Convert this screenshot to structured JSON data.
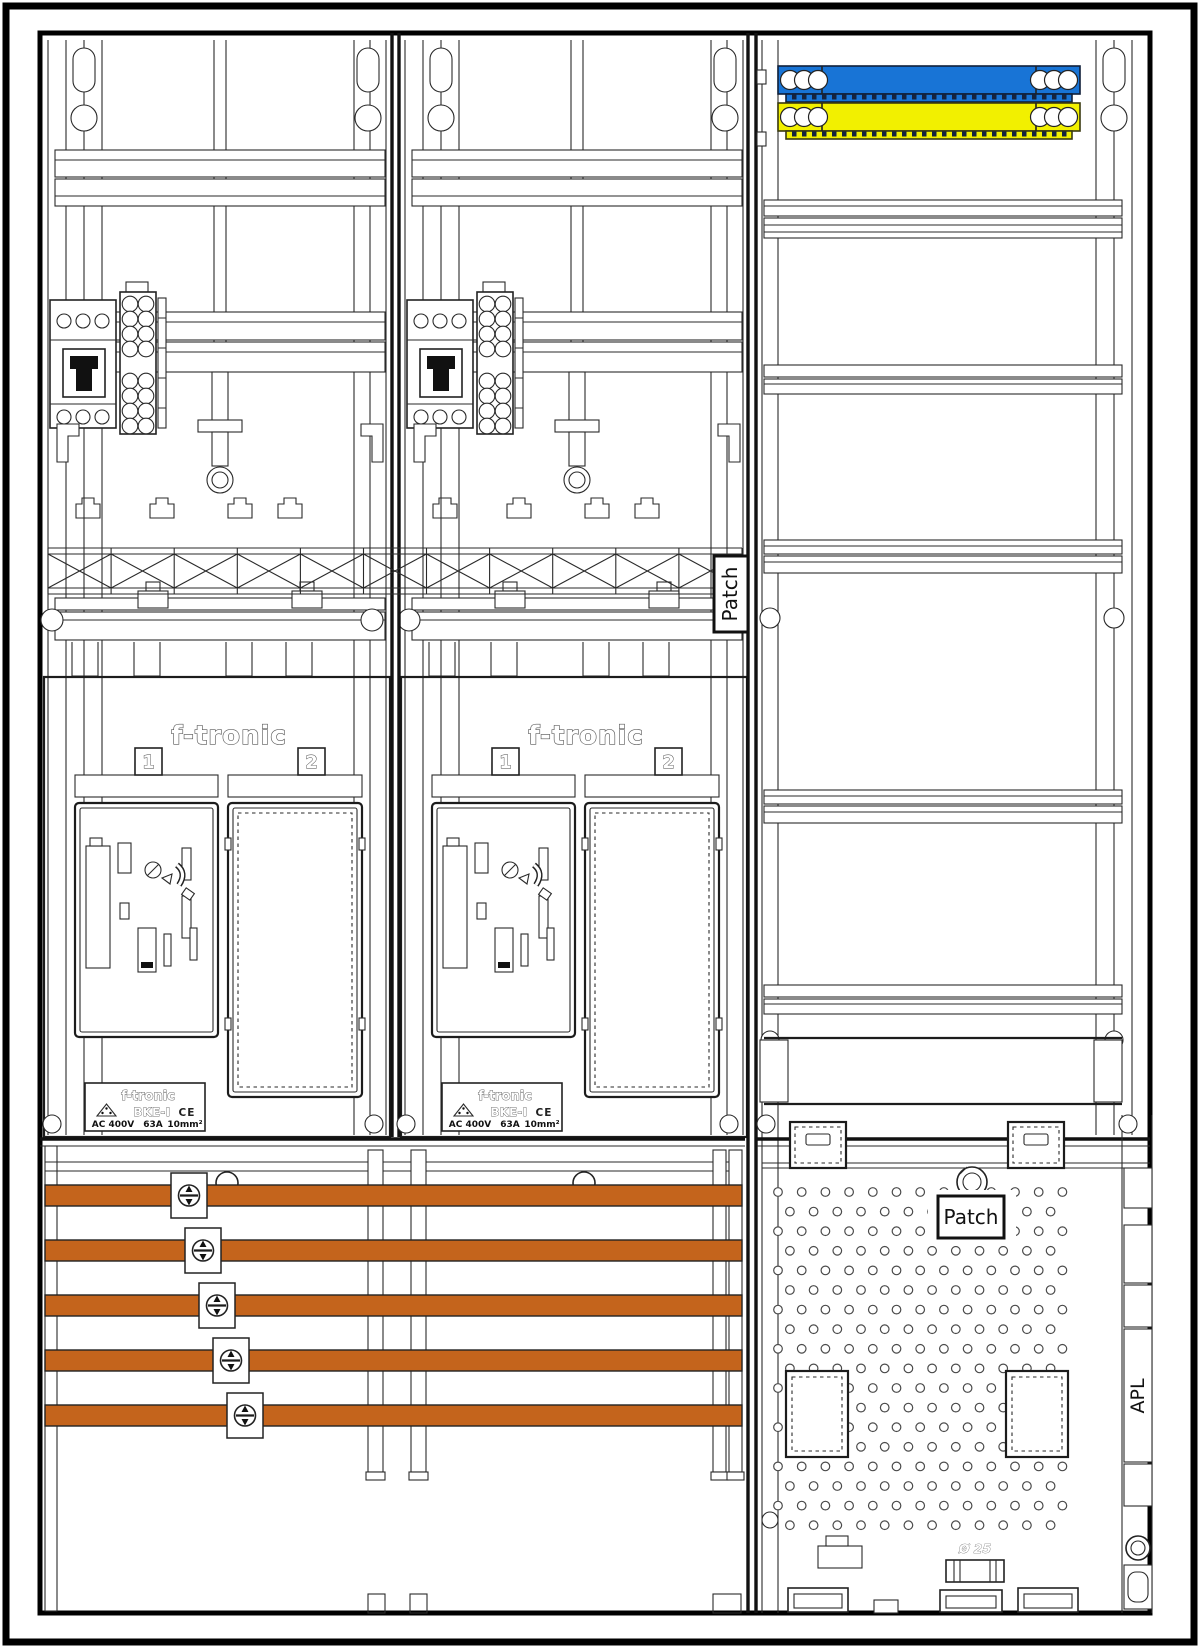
{
  "drawing": {
    "patch_rail_label": "Patch",
    "patch_apl_label": "Patch",
    "apl_label": "APL",
    "gland_diameter_label": "Ø 25"
  },
  "meter_fields": [
    {
      "brand": "f-tronic",
      "slot1": "1",
      "slot2": "2",
      "nameplate": {
        "brand": "f-tronic",
        "model": "BKE-I",
        "ce_mark": "CE",
        "rating_voltage": "AC 400V",
        "rating_current": "63A",
        "rating_wire": "10mm²"
      }
    },
    {
      "brand": "f-tronic",
      "slot1": "1",
      "slot2": "2",
      "nameplate": {
        "brand": "f-tronic",
        "model": "BKE-I",
        "ce_mark": "CE",
        "rating_voltage": "AC 400V",
        "rating_current": "63A",
        "rating_wire": "10mm²"
      }
    }
  ],
  "colors": {
    "busbar_copper": "#C4641C",
    "neutral_bar_blue": "#1874D6",
    "pe_bar_yellow": "#F2F000",
    "line_dark": "#1A1A1A"
  }
}
